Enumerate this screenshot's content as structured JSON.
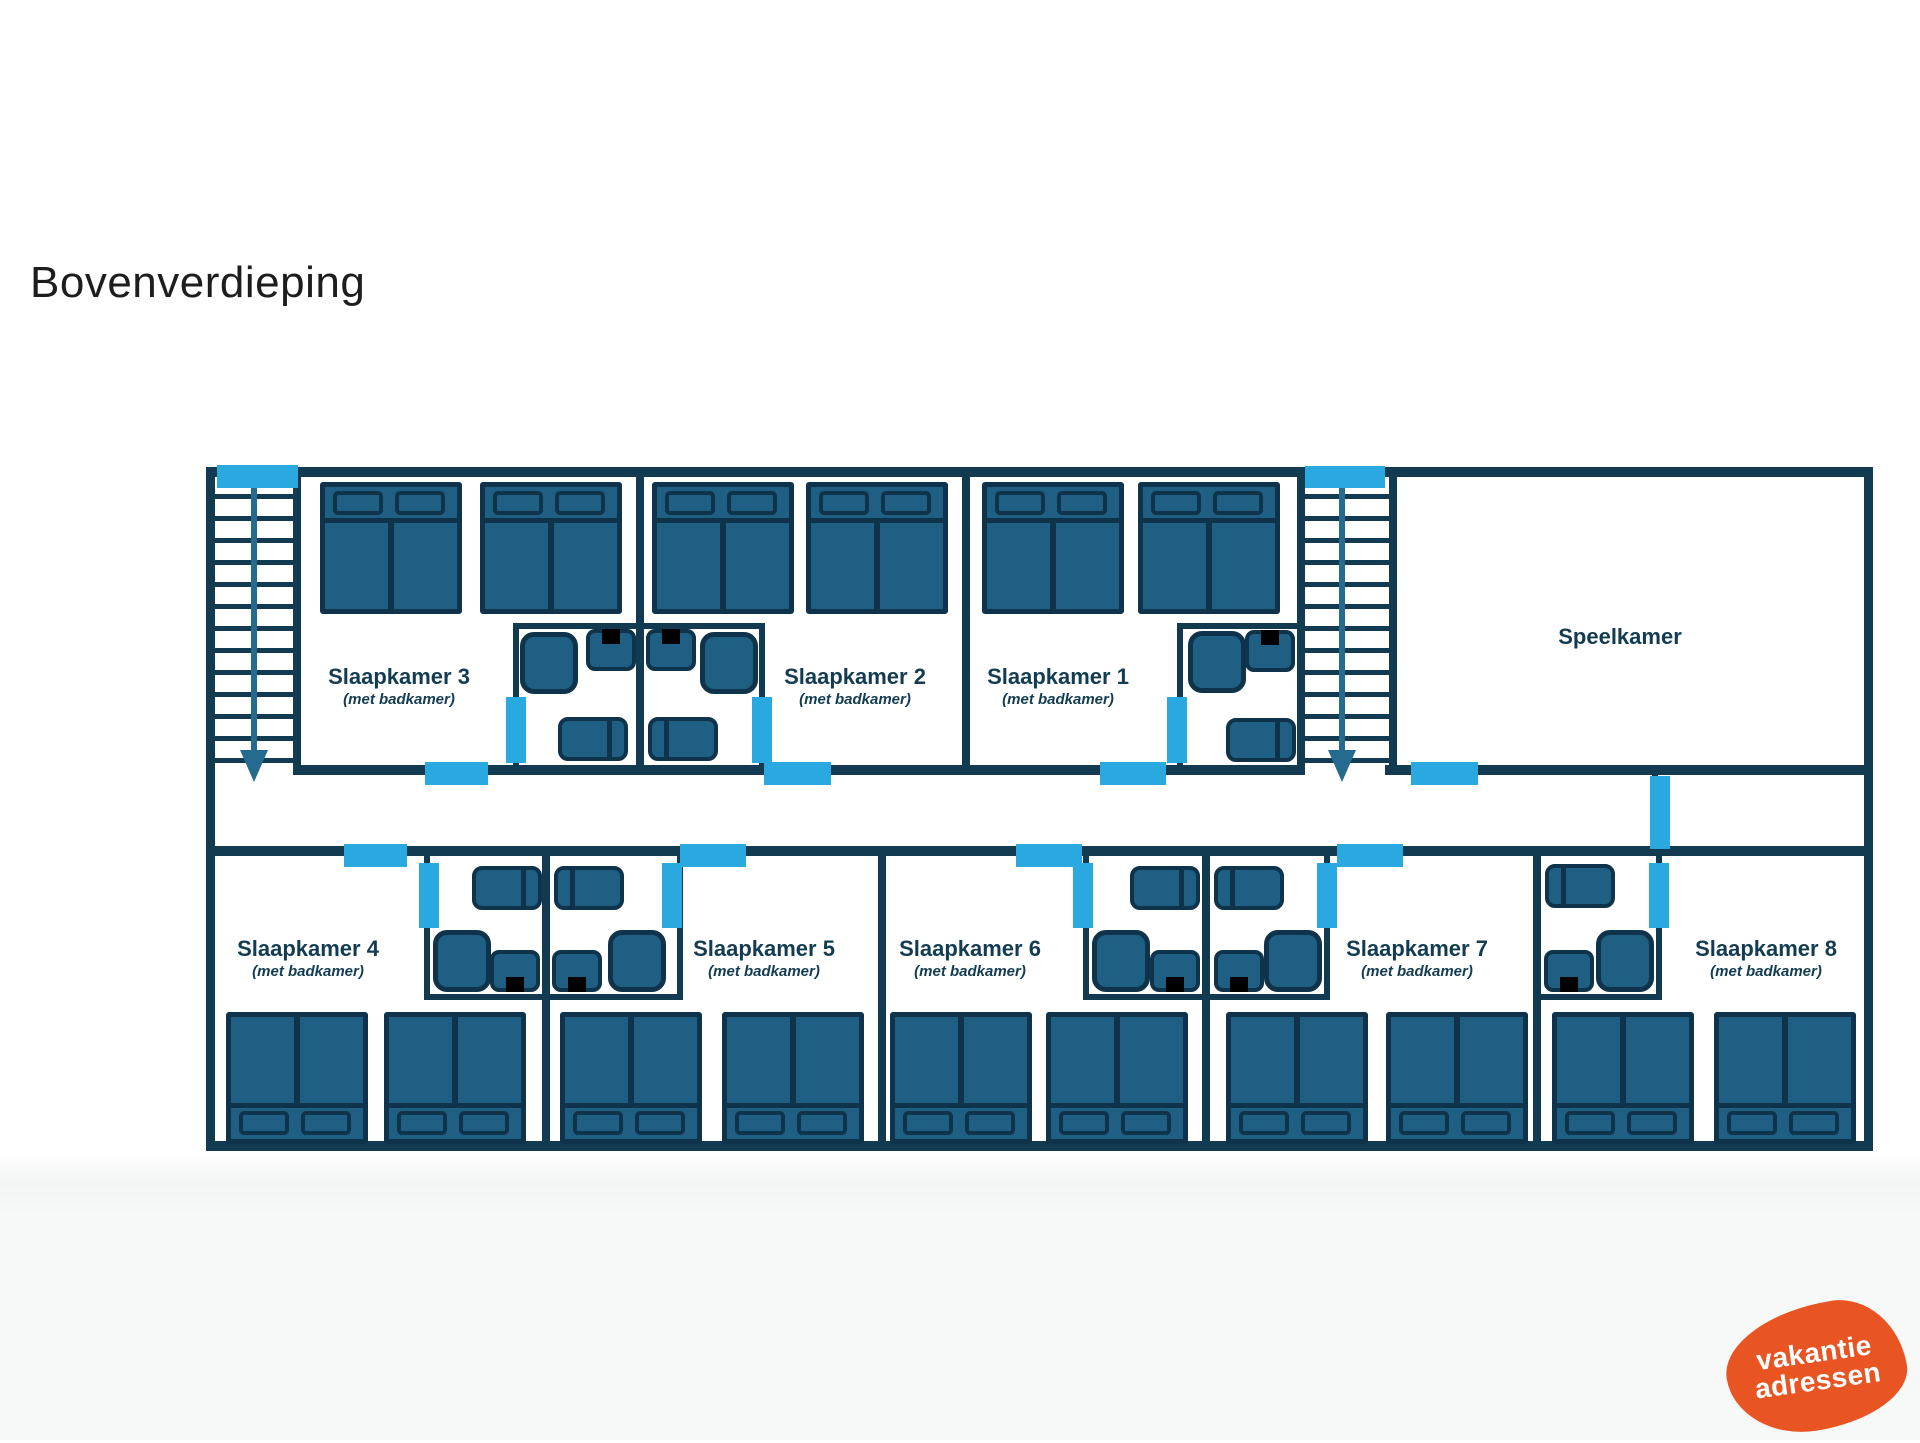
{
  "page": {
    "title": "Bovenverdieping",
    "background": "#ffffff",
    "footer_background": "#f7f8f8"
  },
  "colors": {
    "wall": "#123a50",
    "furniture_fill": "#1e5f83",
    "furniture_outline": "#0f334a",
    "door_marker": "#29a9e0",
    "label_text": "#133c52",
    "stairs_arrow": "#256a8f",
    "logo_orange": "#e85522",
    "logo_text": "#ffffff"
  },
  "floor_plan": {
    "rooms": [
      {
        "id": "slaapkamer-3",
        "name": "Slaapkamer 3",
        "subtitle": "(met badkamer)",
        "double_beds": 2,
        "bathroom_fixtures": [
          "shower",
          "toilet",
          "bathtub"
        ]
      },
      {
        "id": "slaapkamer-2",
        "name": "Slaapkamer 2",
        "subtitle": "(met badkamer)",
        "double_beds": 2,
        "bathroom_fixtures": [
          "shower",
          "toilet",
          "bathtub"
        ]
      },
      {
        "id": "slaapkamer-1",
        "name": "Slaapkamer 1",
        "subtitle": "(met badkamer)",
        "double_beds": 2,
        "bathroom_fixtures": [
          "shower",
          "toilet",
          "bathtub"
        ]
      },
      {
        "id": "speelkamer",
        "name": "Speelkamer",
        "subtitle": "",
        "double_beds": 0,
        "bathroom_fixtures": []
      },
      {
        "id": "slaapkamer-4",
        "name": "Slaapkamer 4",
        "subtitle": "(met badkamer)",
        "double_beds": 2,
        "bathroom_fixtures": [
          "shower",
          "toilet",
          "bathtub"
        ]
      },
      {
        "id": "slaapkamer-5",
        "name": "Slaapkamer 5",
        "subtitle": "(met badkamer)",
        "double_beds": 2,
        "bathroom_fixtures": [
          "shower",
          "toilet",
          "bathtub"
        ]
      },
      {
        "id": "slaapkamer-6",
        "name": "Slaapkamer 6",
        "subtitle": "(met badkamer)",
        "double_beds": 2,
        "bathroom_fixtures": [
          "shower",
          "toilet",
          "bathtub"
        ]
      },
      {
        "id": "slaapkamer-7",
        "name": "Slaapkamer 7",
        "subtitle": "(met badkamer)",
        "double_beds": 2,
        "bathroom_fixtures": [
          "shower",
          "toilet",
          "bathtub"
        ]
      },
      {
        "id": "slaapkamer-8",
        "name": "Slaapkamer 8",
        "subtitle": "(met badkamer)",
        "double_beds": 2,
        "bathroom_fixtures": [
          "shower",
          "toilet",
          "bathtub"
        ]
      }
    ],
    "staircases": [
      {
        "id": "stairs-left",
        "direction": "down"
      },
      {
        "id": "stairs-right",
        "direction": "down"
      }
    ],
    "door_marker_count": 19
  },
  "logo": {
    "line1": "vakantie",
    "line2": "adressen"
  }
}
